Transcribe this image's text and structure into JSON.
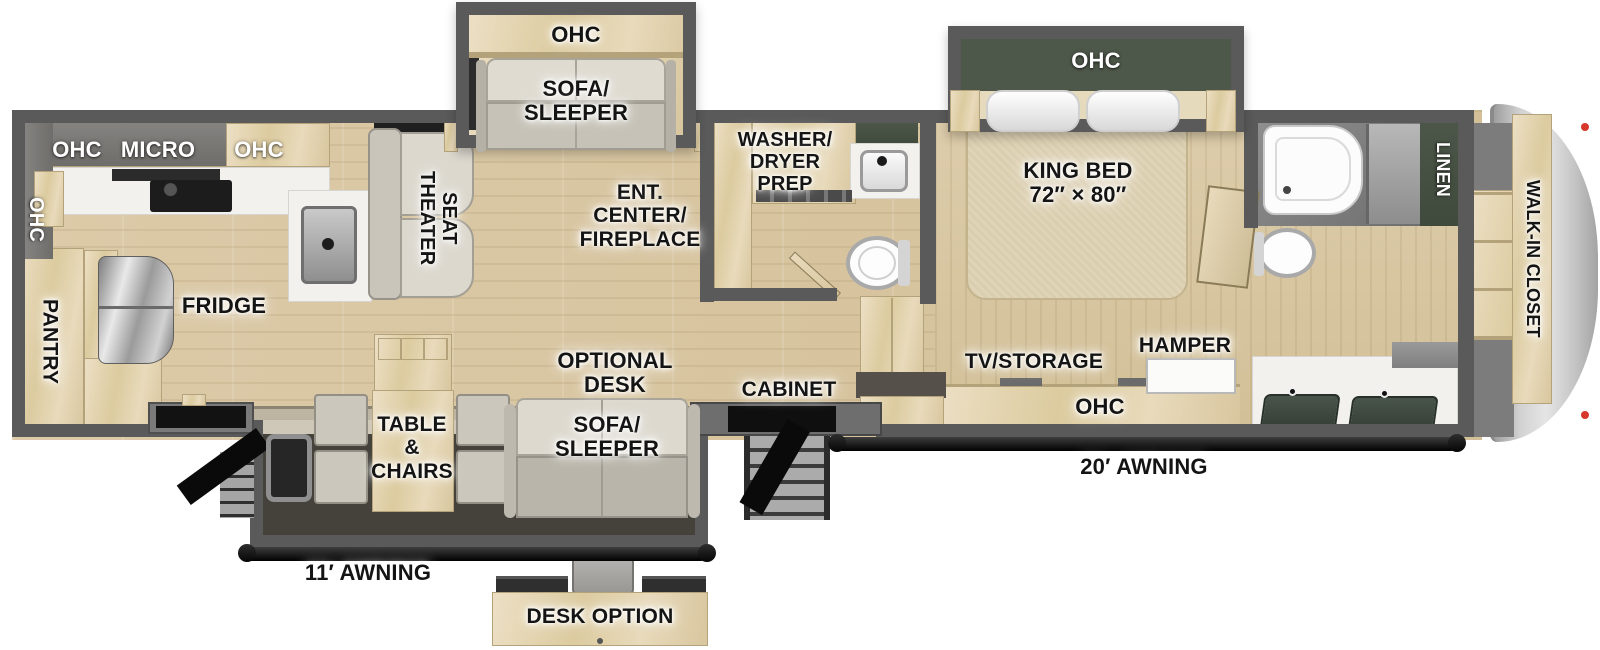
{
  "title": "Fifth wheel RV floorplan",
  "colors": {
    "wall_gray": "#5a5a5a",
    "floor_wood": "#d8c7a4",
    "cabinet_wood": "#e3d5b5",
    "upper_cabinet_gray": "#7b7976",
    "dark_green": "#47513f",
    "awning_black": "#111111",
    "marker_red": "#d6362b",
    "sofa_beige": "#d9d5cb"
  },
  "labels": {
    "kitchen": {
      "ohc_rear": "OHC",
      "ohc_top": "OHC",
      "micro": "MICRO",
      "ohc_top2": "OHC",
      "pantry": "PANTRY",
      "fridge": "FRIDGE"
    },
    "living": {
      "theater_seat": "THEATER\nSEAT",
      "slide_ohc": "OHC",
      "slide_sofa": "SOFA/\nSLEEPER",
      "ent_center": "ENT.\nCENTER/\nFIREPLACE",
      "optional_desk": "OPTIONAL\nDESK",
      "sofa_sleeper": "SOFA/\nSLEEPER",
      "table_chairs": "TABLE\n&\nCHAIRS",
      "cabinet": "CABINET"
    },
    "midbath": {
      "washer_dryer": "WASHER/\nDRYER\nPREP"
    },
    "bedroom": {
      "ohc": "OHC",
      "king_bed": "KING BED\n72″ × 80″",
      "tv_storage": "TV/STORAGE",
      "ohc_cabinet": "OHC",
      "hamper": "HAMPER"
    },
    "bath": {
      "linen": "LINEN"
    },
    "closet": {
      "walk_in": "WALK-IN CLOSET"
    },
    "exterior": {
      "awning_20": "20′ AWNING",
      "awning_11": "11′ AWNING"
    },
    "inset": {
      "desk_option": "DESK OPTION"
    }
  }
}
